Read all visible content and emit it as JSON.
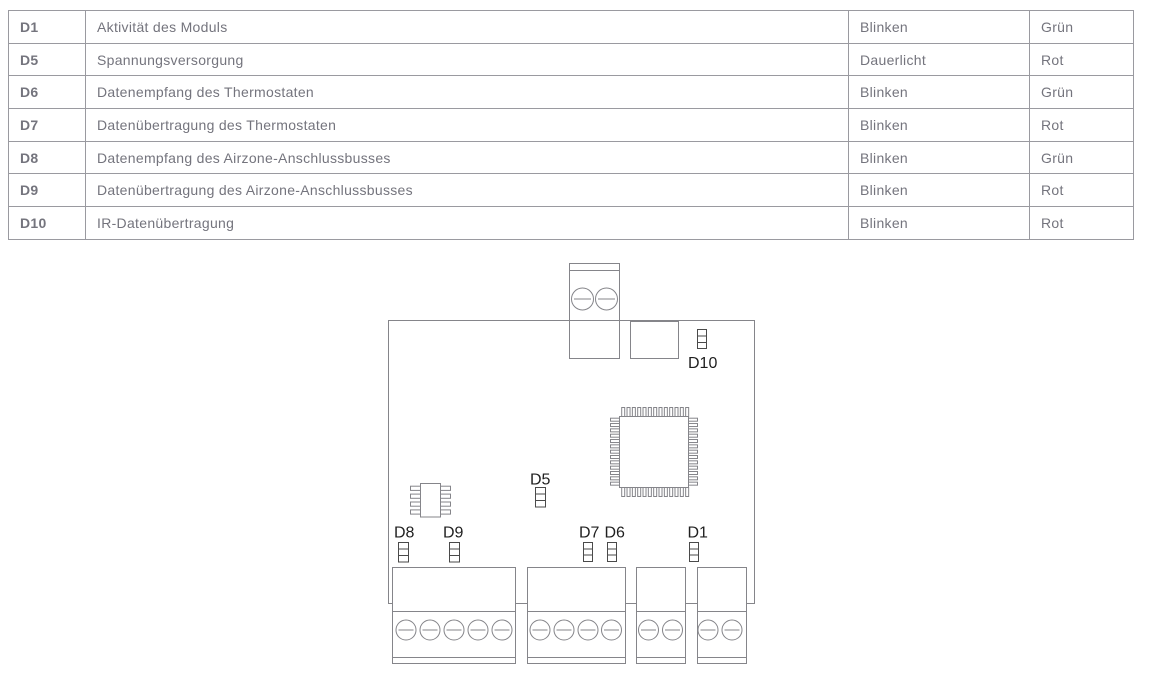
{
  "table": {
    "rows": [
      {
        "led": "D1",
        "description": "Aktivität des Moduls",
        "mode": "Blinken",
        "color": "Grün"
      },
      {
        "led": "D5",
        "description": "Spannungsversorgung",
        "mode": "Dauerlicht",
        "color": "Rot"
      },
      {
        "led": "D6",
        "description": "Datenempfang des Thermostaten",
        "mode": "Blinken",
        "color": "Grün"
      },
      {
        "led": "D7",
        "description": "Datenübertragung des Thermostaten",
        "mode": "Blinken",
        "color": "Rot"
      },
      {
        "led": "D8",
        "description": "Datenempfang des Airzone-Anschlussbusses",
        "mode": "Blinken",
        "color": "Grün"
      },
      {
        "led": "D9",
        "description": "Datenübertragung des Airzone-Anschlussbusses",
        "mode": "Blinken",
        "color": "Rot"
      },
      {
        "led": "D10",
        "description": "IR-Datenübertragung",
        "mode": "Blinken",
        "color": "Rot"
      }
    ]
  },
  "diagram": {
    "labels": {
      "d1": "D1",
      "d5": "D5",
      "d6": "D6",
      "d7": "D7",
      "d8": "D8",
      "d9": "D9",
      "d10": "D10"
    }
  },
  "colors": {
    "background": "#ffffff",
    "table_border": "#9a9aa0",
    "table_text": "#74747d",
    "diagram_stroke": "#85858a",
    "led_stroke": "#4a4a4a",
    "label_text": "#1f1f1f"
  }
}
